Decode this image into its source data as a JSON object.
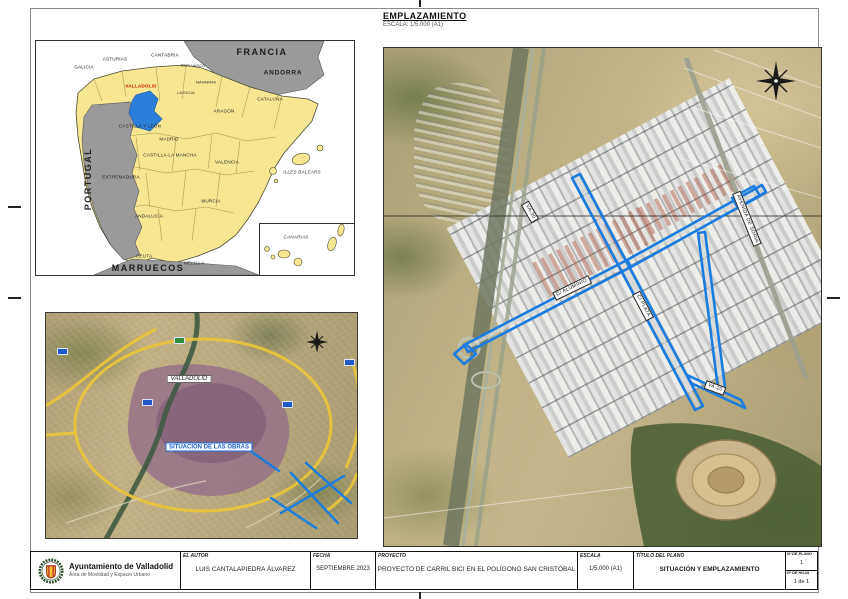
{
  "sheet": {
    "emplazamiento": {
      "title": "EMPLAZAMIENTO",
      "scale": "ESCALA: 1/5.000 (A1)"
    },
    "spain_map": {
      "highlight_label": "VALLADOLID",
      "highlight_color": "#2b7fd9",
      "land_color": "#f7e793",
      "foreign_color": "#9a9a9a",
      "countries": [
        {
          "text": "FRANCIA"
        },
        {
          "text": "ANDORRA"
        },
        {
          "text": "PORTUGAL"
        },
        {
          "text": "MARRUECOS"
        }
      ],
      "regions": [
        {
          "text": "GALICIA"
        },
        {
          "text": "ASTURIAS"
        },
        {
          "text": "CANTABRIA"
        },
        {
          "text": "PAÍS VASCO"
        },
        {
          "text": "NAVARRA"
        },
        {
          "text": "LA RIOJA"
        },
        {
          "text": "ARAGÓN"
        },
        {
          "text": "CATALUÑA"
        },
        {
          "text": "CASTILLA Y LEÓN"
        },
        {
          "text": "MADRID"
        },
        {
          "text": "CASTILLA-LA MANCHA"
        },
        {
          "text": "EXTREMADURA"
        },
        {
          "text": "VALENCIA"
        },
        {
          "text": "MURCIA"
        },
        {
          "text": "ANDALUCÍA"
        },
        {
          "text": "CEUTA"
        },
        {
          "text": "MELILLA"
        },
        {
          "text": "ILLES BALEARS"
        },
        {
          "text": "CANARIAS"
        }
      ]
    },
    "city_map": {
      "city_label": "VALLADOLID",
      "callout": "SITUACIÓN DE LAS OBRAS",
      "highlight_color": "#1b7ce0"
    },
    "site_map": {
      "highlight_color": "#1b7ce0",
      "street_labels": [
        {
          "text": "VA-30"
        },
        {
          "text": "C/ ALUMINIO"
        },
        {
          "text": "C/ PLATA"
        },
        {
          "text": "AVENIDA DE SORIA"
        },
        {
          "text": "VA-20"
        }
      ]
    },
    "title_block": {
      "org": {
        "name": "Ayuntamiento de Valladolid",
        "dept": "Área de Movilidad y Espacio Urbano"
      },
      "autor": {
        "label": "EL AUTOR",
        "value": "LUIS CANTALAPIEDRA ÁLVAREZ"
      },
      "fecha": {
        "label": "FECHA",
        "value": "SEPTIEMBRE 2023"
      },
      "proyecto": {
        "label": "PROYECTO",
        "value": "PROYECTO DE CARRIL BICI EN EL POLÍGONO SAN CRISTÓBAL"
      },
      "escala": {
        "label": "ESCALA",
        "value": "1/5.000 (A1)"
      },
      "titulo": {
        "label": "TÍTULO DEL PLANO",
        "value": "SITUACIÓN Y EMPLAZAMIENTO"
      },
      "num_plano": {
        "label": "Nº DE PLANO",
        "value": "1"
      },
      "num_hoja": {
        "label": "Nº DE HOJA",
        "value": "1 de 1"
      }
    }
  }
}
